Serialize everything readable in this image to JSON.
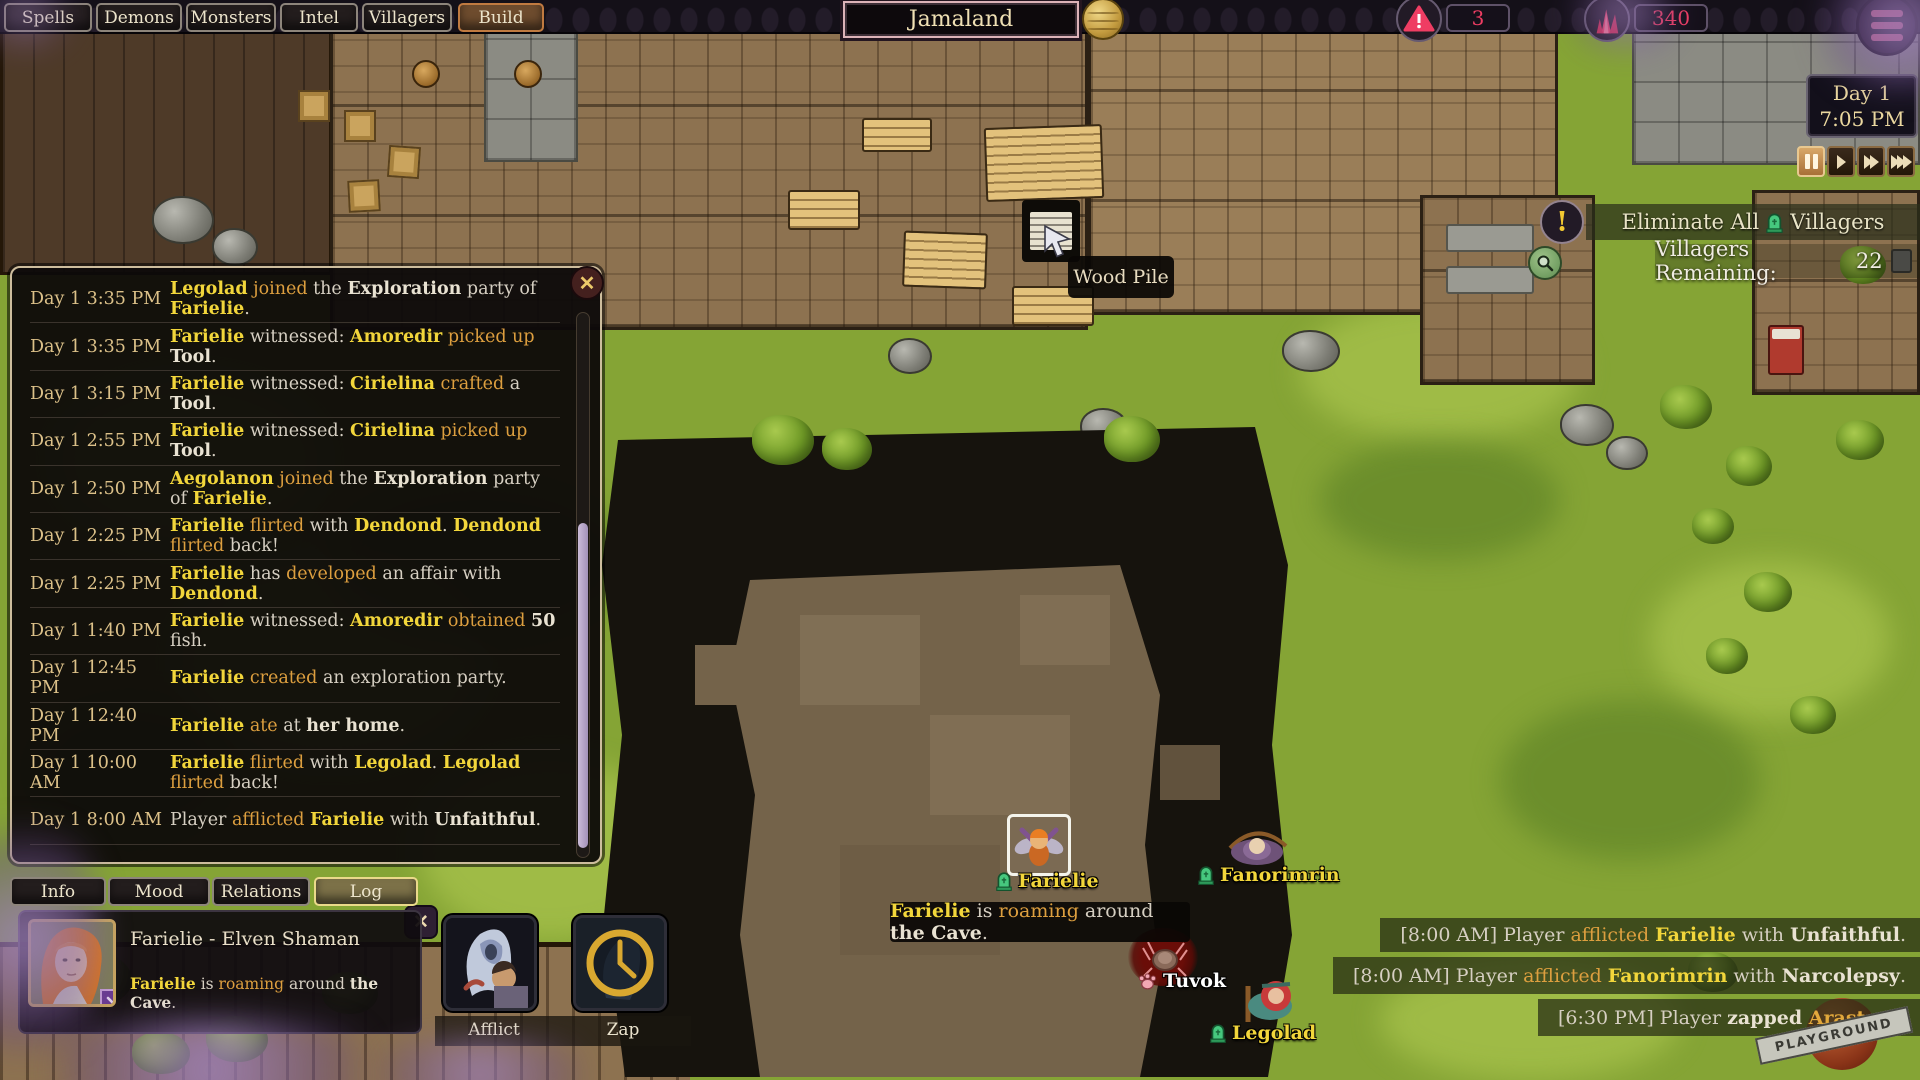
{
  "top_bar": {
    "tabs": [
      {
        "label": "Spells",
        "active": false
      },
      {
        "label": "Demons",
        "active": false
      },
      {
        "label": "Monsters",
        "active": false
      },
      {
        "label": "Intel",
        "active": false
      },
      {
        "label": "Villagers",
        "active": false
      },
      {
        "label": "Build",
        "active": true
      }
    ],
    "world_name": "Jamaland",
    "alert_count": "3",
    "essence_count": "340"
  },
  "clock": {
    "day": "Day 1",
    "time": "7:05 PM"
  },
  "playback": {
    "active": "pause",
    "buttons": [
      "pause",
      "play",
      "fast-forward",
      "fastest-forward"
    ]
  },
  "objective": {
    "title_prefix": "Eliminate All",
    "title_suffix": "Villagers",
    "remaining_label": "Villagers Remaining:",
    "remaining_value": "22"
  },
  "log_panel": {
    "entries": [
      {
        "time": "Day 1 3:35 PM",
        "segments": [
          [
            "n",
            "Legolad"
          ],
          [
            "a",
            " joined"
          ],
          [
            "p",
            " the "
          ],
          [
            "b",
            "Exploration"
          ],
          [
            "p",
            " party of "
          ],
          [
            "n",
            "Farielie"
          ],
          [
            "p",
            "."
          ]
        ]
      },
      {
        "time": "Day 1 3:35 PM",
        "segments": [
          [
            "n",
            "Farielie"
          ],
          [
            "p",
            " witnessed: "
          ],
          [
            "n",
            "Amoredir"
          ],
          [
            "a",
            " picked up "
          ],
          [
            "b",
            "Tool"
          ],
          [
            "p",
            "."
          ]
        ]
      },
      {
        "time": "Day 1 3:15 PM",
        "segments": [
          [
            "n",
            "Farielie"
          ],
          [
            "p",
            " witnessed: "
          ],
          [
            "n",
            "Cirielina"
          ],
          [
            "a",
            " crafted"
          ],
          [
            "p",
            " a "
          ],
          [
            "b",
            "Tool"
          ],
          [
            "p",
            "."
          ]
        ]
      },
      {
        "time": "Day 1 2:55 PM",
        "segments": [
          [
            "n",
            "Farielie"
          ],
          [
            "p",
            " witnessed: "
          ],
          [
            "n",
            "Cirielina"
          ],
          [
            "a",
            " picked up "
          ],
          [
            "b",
            "Tool"
          ],
          [
            "p",
            "."
          ]
        ]
      },
      {
        "time": "Day 1 2:50 PM",
        "segments": [
          [
            "n",
            "Aegolanon"
          ],
          [
            "a",
            " joined"
          ],
          [
            "p",
            " the "
          ],
          [
            "b",
            "Exploration"
          ],
          [
            "p",
            " party of "
          ],
          [
            "n",
            "Farielie"
          ],
          [
            "p",
            "."
          ]
        ]
      },
      {
        "time": "Day 1 2:25 PM",
        "segments": [
          [
            "n",
            "Farielie"
          ],
          [
            "a",
            " flirted"
          ],
          [
            "p",
            " with "
          ],
          [
            "n",
            "Dendond"
          ],
          [
            "p",
            ". "
          ],
          [
            "n",
            "Dendond"
          ],
          [
            "a",
            " flirted"
          ],
          [
            "p",
            " back!"
          ]
        ]
      },
      {
        "time": "Day 1 2:25 PM",
        "segments": [
          [
            "n",
            "Farielie"
          ],
          [
            "p",
            " has "
          ],
          [
            "a",
            "developed"
          ],
          [
            "p",
            " an affair with "
          ],
          [
            "n",
            "Dendond"
          ],
          [
            "p",
            "."
          ]
        ]
      },
      {
        "time": "Day 1 1:40 PM",
        "segments": [
          [
            "n",
            "Farielie"
          ],
          [
            "p",
            " witnessed: "
          ],
          [
            "n",
            "Amoredir"
          ],
          [
            "a",
            " obtained "
          ],
          [
            "b",
            "50"
          ],
          [
            "p",
            " fish."
          ]
        ]
      },
      {
        "time": "Day 1 12:45 PM",
        "segments": [
          [
            "n",
            "Farielie"
          ],
          [
            "a",
            " created"
          ],
          [
            "p",
            " an exploration party."
          ]
        ]
      },
      {
        "time": "Day 1 12:40 PM",
        "segments": [
          [
            "n",
            "Farielie"
          ],
          [
            "a",
            " ate"
          ],
          [
            "p",
            " at "
          ],
          [
            "b",
            "her home"
          ],
          [
            "p",
            "."
          ]
        ]
      },
      {
        "time": "Day 1 10:00 AM",
        "segments": [
          [
            "n",
            "Farielie"
          ],
          [
            "a",
            " flirted"
          ],
          [
            "p",
            " with "
          ],
          [
            "n",
            "Legolad"
          ],
          [
            "p",
            ". "
          ],
          [
            "n",
            "Legolad"
          ],
          [
            "a",
            " flirted"
          ],
          [
            "p",
            " back!"
          ]
        ]
      },
      {
        "time": "Day 1 8:00 AM",
        "segments": [
          [
            "p",
            "Player "
          ],
          [
            "a",
            "afflicted "
          ],
          [
            "n",
            "Farielie"
          ],
          [
            "p",
            " with "
          ],
          [
            "b",
            "Unfaithful"
          ],
          [
            "p",
            "."
          ]
        ]
      }
    ]
  },
  "character_tabs": [
    {
      "label": "Info",
      "active": false
    },
    {
      "label": "Mood",
      "active": false
    },
    {
      "label": "Relations",
      "active": false
    },
    {
      "label": "Log",
      "active": true
    }
  ],
  "character_card": {
    "title": "Farielie - Elven Shaman",
    "status_segments": [
      [
        "n",
        "Farielie"
      ],
      [
        "p",
        " is "
      ],
      [
        "a",
        "roaming"
      ],
      [
        "p",
        " around "
      ],
      [
        "b",
        "the Cave"
      ],
      [
        "p",
        "."
      ]
    ]
  },
  "action_buttons": [
    {
      "label": "Afflict"
    },
    {
      "label": "Zap"
    }
  ],
  "event_messages": [
    {
      "segments": [
        [
          "p",
          "[8:00 AM] Player "
        ],
        [
          "a",
          "afflicted "
        ],
        [
          "n",
          "Farielie"
        ],
        [
          "p",
          " with "
        ],
        [
          "b",
          "Unfaithful"
        ],
        [
          "p",
          "."
        ]
      ]
    },
    {
      "segments": [
        [
          "p",
          "[8:00 AM] Player "
        ],
        [
          "a",
          "afflicted "
        ],
        [
          "n",
          "Fanorimrin"
        ],
        [
          "p",
          " with "
        ],
        [
          "b",
          "Narcolepsy"
        ],
        [
          "p",
          "."
        ]
      ]
    },
    {
      "segments": [
        [
          "p",
          "[6:30 PM] Player "
        ],
        [
          "b",
          "zapped "
        ],
        [
          "o",
          "Arastara"
        ],
        [
          "p",
          "."
        ]
      ]
    }
  ],
  "map": {
    "tooltip_wood_pile": "Wood Pile",
    "status_tooltip_segments": [
      [
        "n",
        "Farielie"
      ],
      [
        "p",
        " is "
      ],
      [
        "a",
        "roaming"
      ],
      [
        "p",
        " around "
      ],
      [
        "b",
        "the Cave"
      ],
      [
        "p",
        "."
      ]
    ],
    "villagers": [
      {
        "name": "Farielie",
        "icon": "tombstone"
      },
      {
        "name": "Fanorimrin",
        "icon": "tombstone"
      },
      {
        "name": "Tuvok",
        "icon": "paw"
      },
      {
        "name": "Legolad",
        "icon": "tombstone"
      }
    ]
  },
  "watermark": "PLAYGROUND",
  "colors": {
    "accent_pink": "#ef3d63",
    "name_yellow": "#f2d63b",
    "action_orange": "#dd9f3f",
    "ui_cream": "#ece4cb",
    "tombstone_green": "#46c87e"
  }
}
